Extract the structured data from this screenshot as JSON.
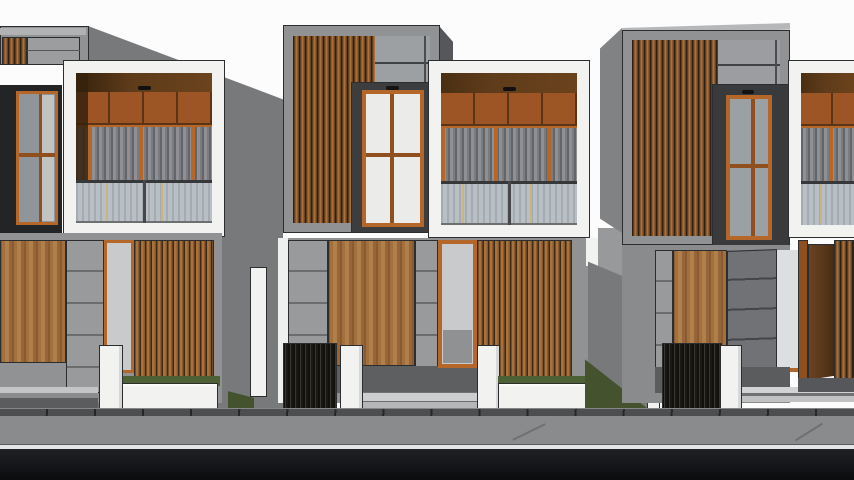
{
  "scene": {
    "type": "3d-architectural-render",
    "subject": "row-of-modern-minimalist-two-story-townhouses",
    "view": "front-street-elevation",
    "visible_text": "none",
    "houses": [
      {
        "id": "house-1",
        "position": "left",
        "cropped": "left-edge",
        "floors": 2,
        "features": [
          "roof-parapet-slats",
          "dark-window-bay-orange-frame",
          "white-balcony-box",
          "balcony-wood-panels",
          "corrugated-metal-infill",
          "glass-railing",
          "ground-wood-door",
          "concrete-block-column",
          "orange-glass-door",
          "wood-slat-screen",
          "white-gate-pillar",
          "white-planter-wall",
          "grass-strip"
        ]
      },
      {
        "id": "house-2",
        "position": "center",
        "cropped": "none",
        "floors": 2,
        "features": [
          "slat-facade-box",
          "orange-frame-window-4-pane",
          "white-balcony-box",
          "balcony-wood-panels",
          "corrugated-metal-infill",
          "glass-railing",
          "ground-wood-door",
          "concrete-block-columns",
          "orange-glass-door",
          "wood-slat-screen",
          "dark-slat-fence",
          "white-gate-pillars",
          "entry-steps",
          "white-planter-wall",
          "grass-strip"
        ]
      },
      {
        "id": "house-3",
        "position": "right",
        "cropped": "none",
        "floors": 2,
        "features": [
          "slat-facade-box",
          "orange-frame-window-4-pane",
          "side-wall-perspective",
          "ground-wood-door",
          "dark-concrete-column",
          "dark-slat-fence",
          "white-gate-pillar",
          "entry-steps",
          "separation-fence-wall",
          "grass-triangle"
        ]
      },
      {
        "id": "house-4",
        "position": "far-right",
        "cropped": "right-edge",
        "floors": 2,
        "features": [
          "white-balcony-box",
          "balcony-wood-panels",
          "corrugated-metal-infill",
          "glass-railing",
          "open-wood-entry-door",
          "wood-slat-screen"
        ]
      }
    ],
    "street_layers_front_to_back": [
      "black-asphalt",
      "white-road-line",
      "gray-road",
      "tiled-sidewalk",
      "grass-and-fences"
    ]
  },
  "palette": {
    "sky": "#fcfcfc",
    "outline": "#2c2d2e",
    "concrete": "#909294",
    "concrete-light": "#9da0a2",
    "concrete-dark": "#77797b",
    "concrete-side": "#808284",
    "white-frame": "#f2f2f0",
    "white-shade": "#d6d7d8",
    "orange": "#b5672a",
    "orange-dark": "#8f4f1e",
    "soffit": "#5e3b1a",
    "soffit-deep": "#36220d",
    "wood-panel": "#9d5526",
    "wood-seam": "#5a3414",
    "slat-dark": "#2e2012",
    "slat-mid": "#8a5a2e",
    "slat-light": "#a9713c",
    "door-wood": "#a1703e",
    "door-wood-dark": "#8a5a30",
    "door-wood-light": "#b07f4a",
    "corr-light": "#8e9094",
    "corr-dark": "#63656a",
    "glass-rail": "#b9c0c5",
    "glass-rail-stripe": "#a5acb1",
    "glass-tan": "#c9b584",
    "window-glass": "#ebebe9",
    "window-glass-gray": "#9aa0a4",
    "door-glass": "#c8cacb",
    "fence-dark": "#13110e",
    "fence-line": "#38362f",
    "grass": "#4e6134",
    "grass-dark": "#45522e",
    "entry-floor": "#5d5f61",
    "step-light": "#cdced0",
    "step-mid": "#b4b6b8",
    "pave-light": "#c4c5c7",
    "pave-mid": "#8b8c8e",
    "sidewalk": "#4c4e50",
    "road": "#8a8b8d",
    "road-line": "#e4e5e7",
    "asphalt-top": "#202124",
    "asphalt-bottom": "#0b0c0e"
  }
}
